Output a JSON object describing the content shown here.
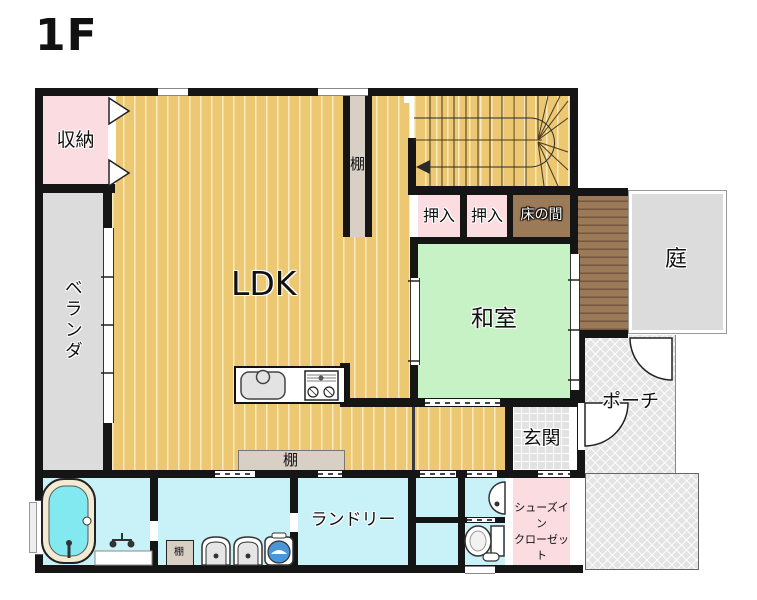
{
  "floor_label": "1F",
  "rooms": {
    "storage": {
      "label": "収納"
    },
    "ldk": {
      "label": "LDK"
    },
    "veranda": {
      "label": "ベランダ"
    },
    "oshiire_left": {
      "label": "押入"
    },
    "oshiire_right": {
      "label": "押入"
    },
    "tokonoma": {
      "label": "床の間"
    },
    "washitsu": {
      "label": "和室"
    },
    "garden": {
      "label": "庭"
    },
    "porch": {
      "label": "ポーチ"
    },
    "genkan": {
      "label": "玄関"
    },
    "laundry": {
      "label": "ランドリー"
    },
    "shoe_closet": {
      "label_line1": "シューズイン",
      "label_line2": "クローゼット"
    },
    "shelf_tall": {
      "label": "棚"
    },
    "shelf_bottom": {
      "label": "棚"
    },
    "shelf_washroom": {
      "label": "棚"
    }
  },
  "colors": {
    "wood": "#ecc873",
    "closet_pink": "#fbdce0",
    "tatami_green": "#c6f2c5",
    "outdoor_gray": "#dcdcdc",
    "deck_brown": "#9b7a58",
    "wet_area_blue": "#c9f2f8",
    "shelf_beige": "#d8d0c5",
    "wall_black": "#151515",
    "washer_blue": "#4a96d8",
    "tub_cyan": "#82e9f0"
  }
}
